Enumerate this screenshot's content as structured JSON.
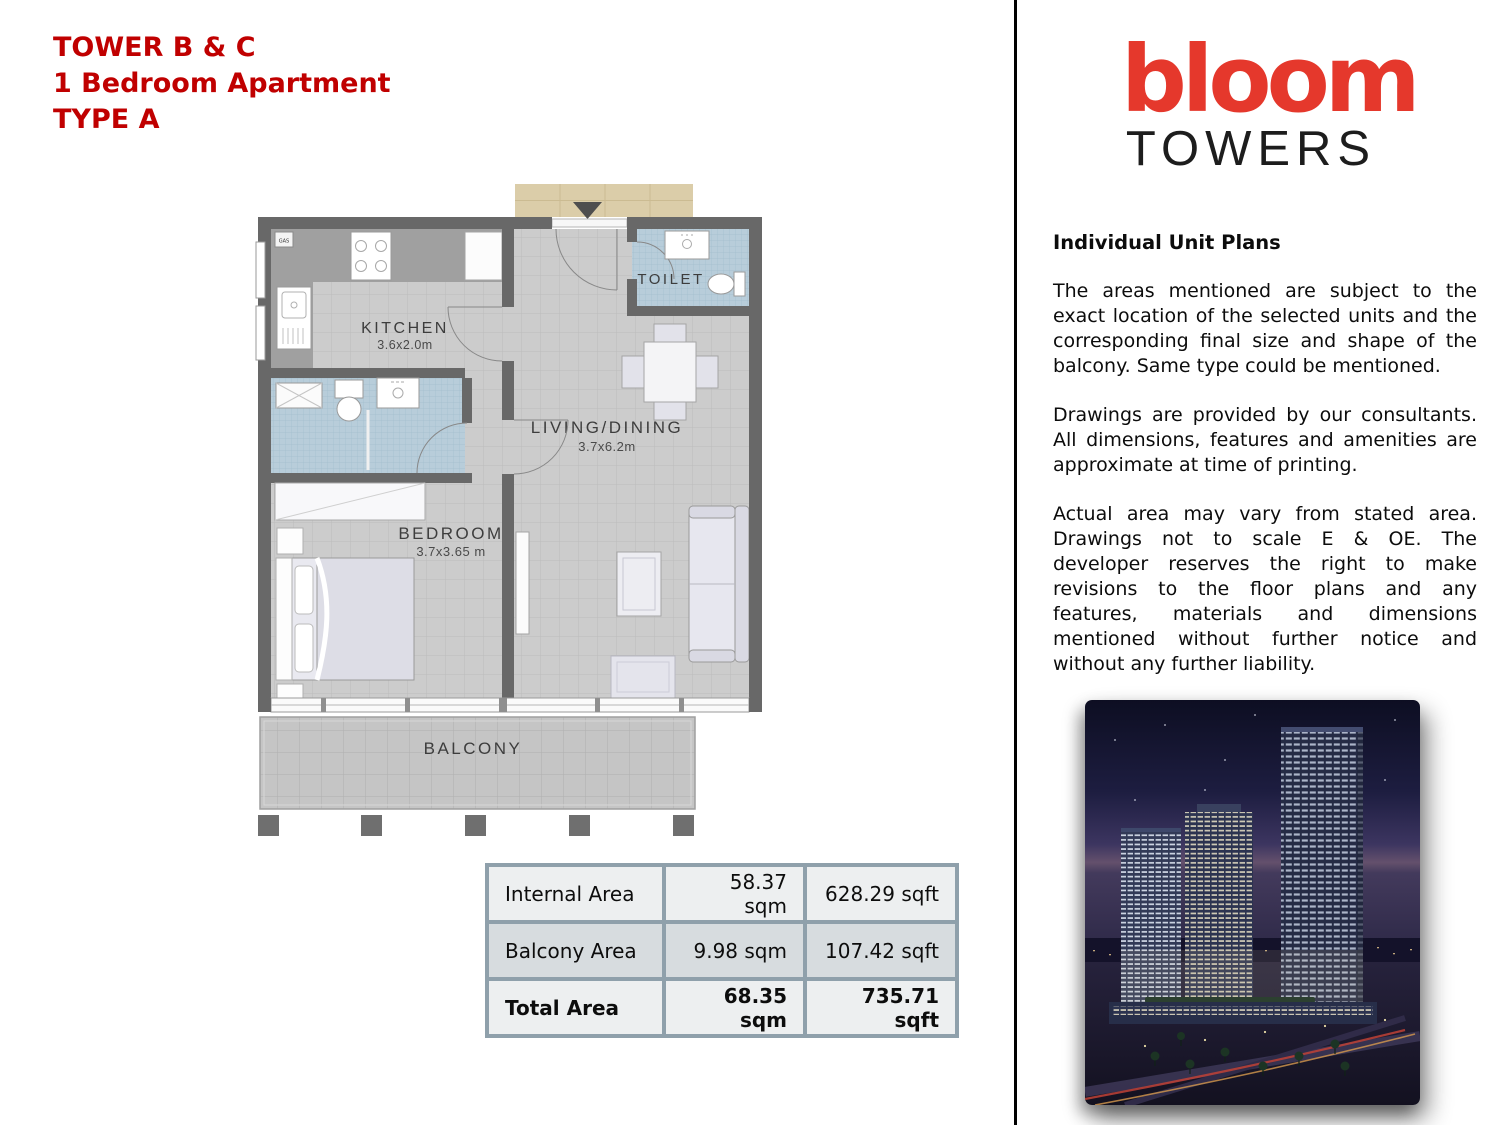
{
  "header": {
    "title_lines": [
      "TOWER B & C",
      "1 Bedroom Apartment",
      "TYPE A"
    ],
    "title_color": "#C00000"
  },
  "logo": {
    "brand": "bloom",
    "subtitle": "TOWERS",
    "brand_color": "#E5382C"
  },
  "sidebar": {
    "heading": "Individual Unit Plans",
    "paragraphs": [
      "The areas mentioned are subject to the exact location of the selected units and the corresponding final size and shape of the balcony. Same type could be mentioned.",
      "Drawings are provided by our consultants. All dimensions, features and amenities are approximate at time of printing.",
      "Actual area may vary from stated area. Drawings not to scale E & OE. The developer reserves the right to make revisions to the floor plans and any features, materials and dimensions mentioned without further notice and without any further liability."
    ]
  },
  "floorplan": {
    "labels": {
      "kitchen": "KITCHEN",
      "kitchen_dims": "3.6x2.0m",
      "toilet": "TOILET",
      "living": "LIVING/DINING",
      "living_dims": "3.7x6.2m",
      "bedroom": "BEDROOM",
      "bedroom_dims": "3.7x3.65 m",
      "balcony": "BALCONY",
      "gas": "GAS"
    },
    "colors": {
      "wall": "#686868",
      "floor_tile": "#CCCCCC",
      "mosaic_blue": "#B8CDDA",
      "entry_tan": "#DBCDA9"
    }
  },
  "area_table": {
    "rows": [
      {
        "label": "Internal Area",
        "sqm": "58.37 sqm",
        "sqft": "628.29 sqft"
      },
      {
        "label": "Balcony Area",
        "sqm": "9.98 sqm",
        "sqft": "107.42 sqft"
      },
      {
        "label": "Total Area",
        "sqm": "68.35 sqm",
        "sqft": "735.71 sqft"
      }
    ]
  }
}
